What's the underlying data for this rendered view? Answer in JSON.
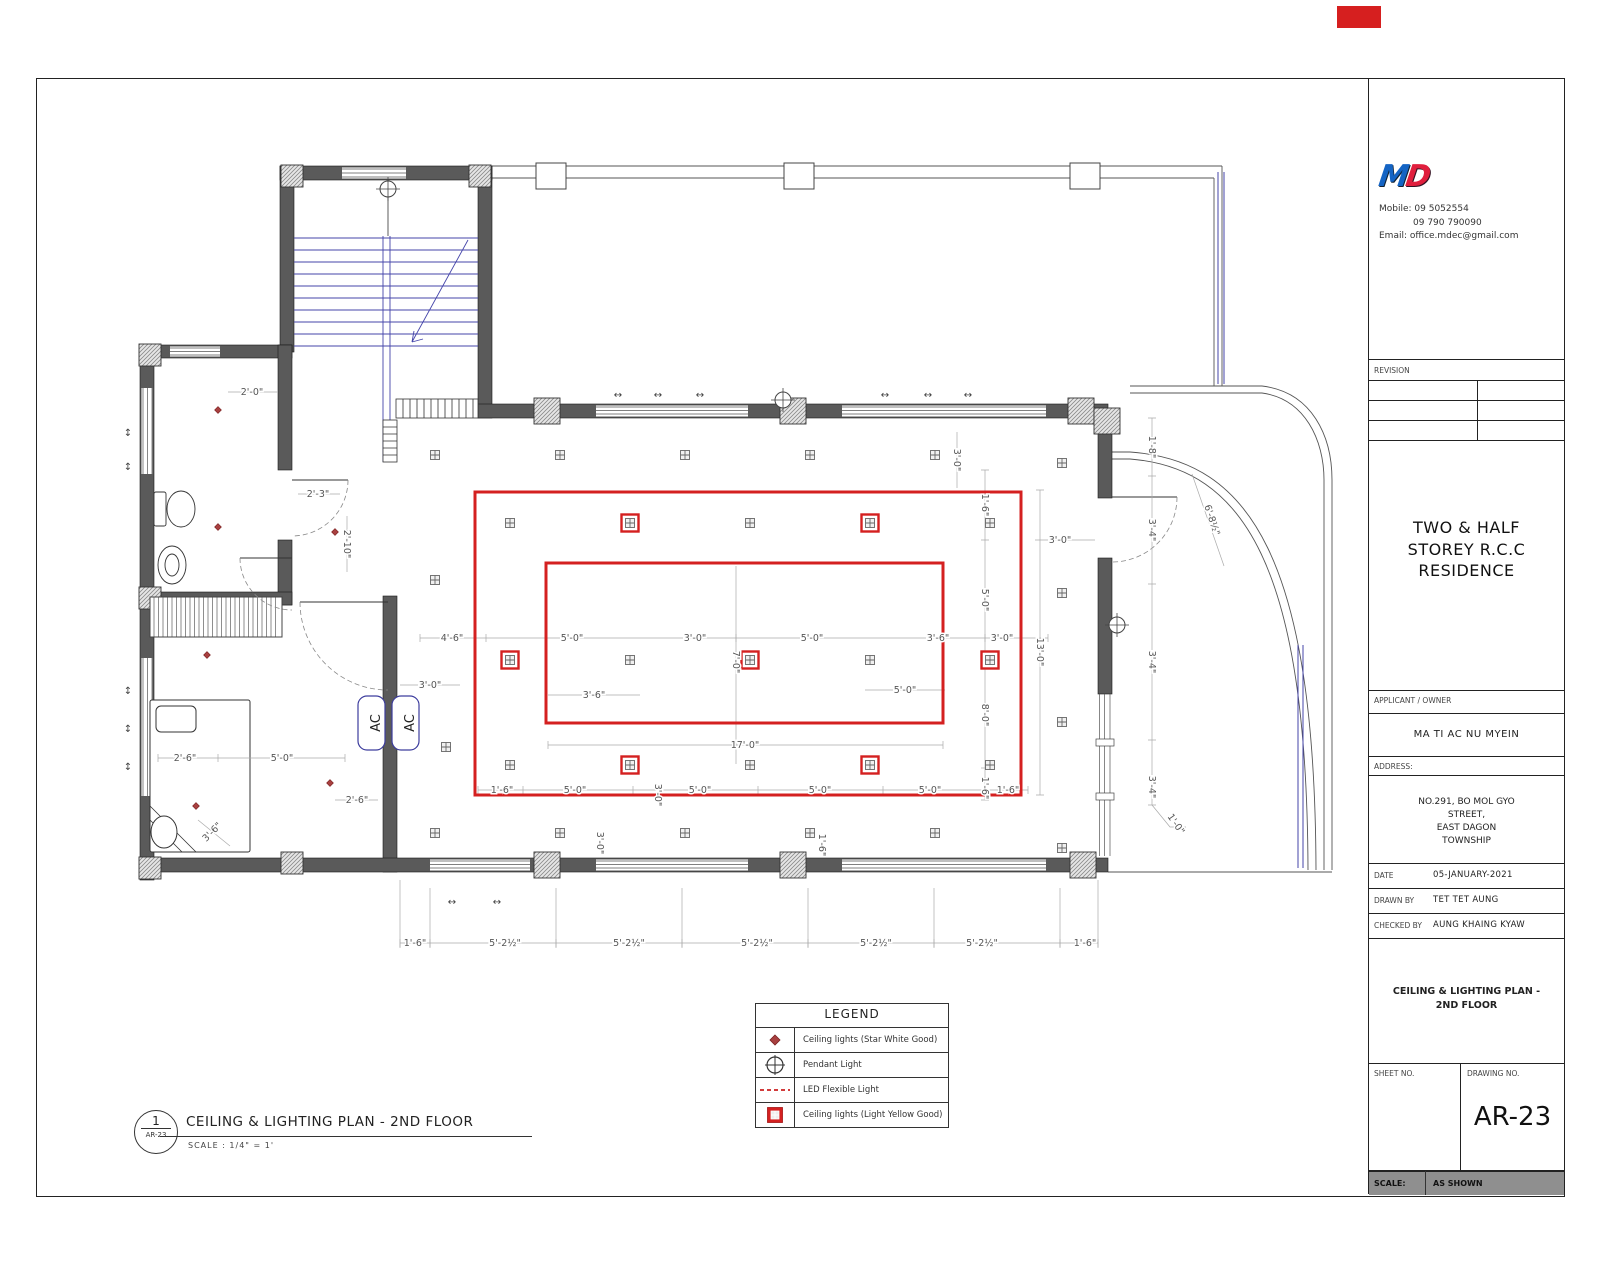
{
  "sheet": {
    "corner_tag_color": "#d61f1f"
  },
  "company": {
    "logo_m": "M",
    "logo_d": "D",
    "mobile": "Mobile: 09 5052554",
    "mobile2": "09 790 790090",
    "email": "Email: office.mdec@gmail.com"
  },
  "title_block": {
    "revision_label": "REVISION",
    "project_title": "TWO & HALF STOREY R.C.C RESIDENCE",
    "applicant_label": "APPLICANT / OWNER",
    "applicant_name": "MA TI AC NU MYEIN",
    "address_label": "ADDRESS:",
    "address_line1": "NO.291, BO MOL GYO",
    "address_line2": "STREET,",
    "address_line3": "EAST DAGON",
    "address_line4": "TOWNSHIP",
    "date_label": "DATE",
    "date_value": "05-JANUARY-2021",
    "drawn_label": "DRAWN BY",
    "drawn_value": "TET TET AUNG",
    "checked_label": "CHECKED BY",
    "checked_value": "AUNG KHAING KYAW",
    "sheet_title": "CEILING & LIGHTING PLAN - 2ND FLOOR",
    "sheet_no_label": "SHEET NO.",
    "drawing_no_label": "DRAWING NO.",
    "drawing_no": "AR-23",
    "scale_label": "SCALE:",
    "scale_value": "AS SHOWN"
  },
  "legend": {
    "title": "LEGEND",
    "rows": [
      {
        "symbol": "ceiling-light-dot-icon",
        "label": "Ceiling lights (Star White Good)"
      },
      {
        "symbol": "pendant-light-icon",
        "label": "Pendant Light"
      },
      {
        "symbol": "led-flexible-light-icon",
        "label": "LED Flexible Light"
      },
      {
        "symbol": "ceiling-light-yellow-icon",
        "label": "Ceiling lights (Light Yellow Good)"
      }
    ]
  },
  "drawing_label": {
    "number": "1",
    "ref": "AR-23",
    "title": "CEILING & LIGHTING PLAN - 2ND FLOOR",
    "scale": "SCALE : 1/4\" = 1'"
  },
  "plan": {
    "ac_label": "AC",
    "colors": {
      "red": "#d42020",
      "wall": "#5a5a5a",
      "stair_blue": "#4545aa",
      "dim_text": "#555555"
    },
    "red_boxes": [
      {
        "x": 475,
        "y": 492,
        "w": 546,
        "h": 303
      },
      {
        "x": 546,
        "y": 563,
        "w": 397,
        "h": 160
      }
    ],
    "lights": {
      "gray": [
        [
          435,
          455
        ],
        [
          560,
          455
        ],
        [
          685,
          455
        ],
        [
          810,
          455
        ],
        [
          935,
          455
        ],
        [
          435,
          580
        ],
        [
          510,
          523
        ],
        [
          750,
          523
        ],
        [
          990,
          523
        ],
        [
          630,
          660
        ],
        [
          870,
          660
        ],
        [
          446,
          747
        ],
        [
          510,
          765
        ],
        [
          750,
          765
        ],
        [
          990,
          765
        ],
        [
          435,
          833
        ],
        [
          560,
          833
        ],
        [
          685,
          833
        ],
        [
          810,
          833
        ],
        [
          935,
          833
        ],
        [
          1062,
          463
        ],
        [
          1062,
          593
        ],
        [
          1062,
          722
        ],
        [
          1062,
          848
        ]
      ],
      "red": [
        [
          630,
          523
        ],
        [
          870,
          523
        ],
        [
          510,
          660
        ],
        [
          750,
          660
        ],
        [
          990,
          660
        ],
        [
          630,
          765
        ],
        [
          870,
          765
        ]
      ],
      "dots": [
        [
          218,
          410
        ],
        [
          218,
          527
        ],
        [
          335,
          532
        ],
        [
          207,
          655
        ],
        [
          330,
          783
        ],
        [
          196,
          806
        ]
      ],
      "pendants": [
        [
          783,
          400
        ],
        [
          1117,
          625
        ],
        [
          388,
          189
        ]
      ]
    },
    "dimensions": [
      [
        452,
        638,
        "4'-6\"",
        0
      ],
      [
        572,
        638,
        "5'-0\"",
        0
      ],
      [
        695,
        638,
        "3'-0\"",
        0
      ],
      [
        812,
        638,
        "5'-0\"",
        0
      ],
      [
        938,
        638,
        "3'-6\"",
        0
      ],
      [
        1002,
        638,
        "3'-0\"",
        0
      ],
      [
        430,
        685,
        "3'-0\"",
        0
      ],
      [
        594,
        695,
        "3'-6\"",
        0
      ],
      [
        905,
        690,
        "5'-0\"",
        0
      ],
      [
        736,
        662,
        "7'-0\"",
        90
      ],
      [
        745,
        745,
        "17'-0\"",
        0
      ],
      [
        502,
        790,
        "1'-6\"",
        0
      ],
      [
        575,
        790,
        "5'-0\"",
        0
      ],
      [
        700,
        790,
        "5'-0\"",
        0
      ],
      [
        820,
        790,
        "5'-0\"",
        0
      ],
      [
        930,
        790,
        "5'-0\"",
        0
      ],
      [
        1008,
        790,
        "1'-6\"",
        0
      ],
      [
        658,
        795,
        "3'-0\"",
        90
      ],
      [
        600,
        843,
        "3'-0\"",
        90
      ],
      [
        822,
        845,
        "1'-6\"",
        90
      ],
      [
        985,
        505,
        "1'-6\"",
        90
      ],
      [
        985,
        600,
        "5'-0\"",
        90
      ],
      [
        985,
        715,
        "8'-0\"",
        90
      ],
      [
        985,
        788,
        "1'-6\"",
        90
      ],
      [
        1040,
        652,
        "13'-0\"",
        90
      ],
      [
        1060,
        540,
        "3'-0\"",
        0
      ],
      [
        1152,
        447,
        "1'-8\"",
        90
      ],
      [
        1152,
        530,
        "3'-4\"",
        90
      ],
      [
        1152,
        662,
        "3'-4\"",
        90
      ],
      [
        1152,
        787,
        "3'-4\"",
        90
      ],
      [
        1176,
        824,
        "1'-0\"",
        55
      ],
      [
        1212,
        520,
        "6'-8½\"",
        72
      ],
      [
        957,
        460,
        "3'-0\"",
        90
      ],
      [
        252,
        392,
        "2'-0\"",
        0
      ],
      [
        318,
        494,
        "2'-3\"",
        0
      ],
      [
        347,
        544,
        "2'-10\"",
        90
      ],
      [
        185,
        758,
        "2'-6\"",
        0
      ],
      [
        282,
        758,
        "5'-0\"",
        0
      ],
      [
        357,
        800,
        "2'-6\"",
        0
      ],
      [
        212,
        832,
        "3'-6\"",
        -45
      ],
      [
        415,
        943,
        "1'-6\"",
        0
      ],
      [
        505,
        943,
        "5'-2½\"",
        0
      ],
      [
        629,
        943,
        "5'-2½\"",
        0
      ],
      [
        757,
        943,
        "5'-2½\"",
        0
      ],
      [
        876,
        943,
        "5'-2½\"",
        0
      ],
      [
        982,
        943,
        "5'-2½\"",
        0
      ],
      [
        1085,
        943,
        "1'-6\"",
        0
      ]
    ],
    "arrows_h": [
      [
        618,
        398
      ],
      [
        658,
        398
      ],
      [
        700,
        398
      ],
      [
        885,
        398
      ],
      [
        928,
        398
      ],
      [
        968,
        398
      ],
      [
        452,
        905
      ],
      [
        497,
        905
      ]
    ],
    "arrows_v": [
      [
        128,
        436
      ],
      [
        128,
        470
      ],
      [
        128,
        694
      ],
      [
        128,
        732
      ],
      [
        128,
        770
      ]
    ],
    "arrow_h_glyph": "↔",
    "arrow_v_glyph": "↕"
  }
}
